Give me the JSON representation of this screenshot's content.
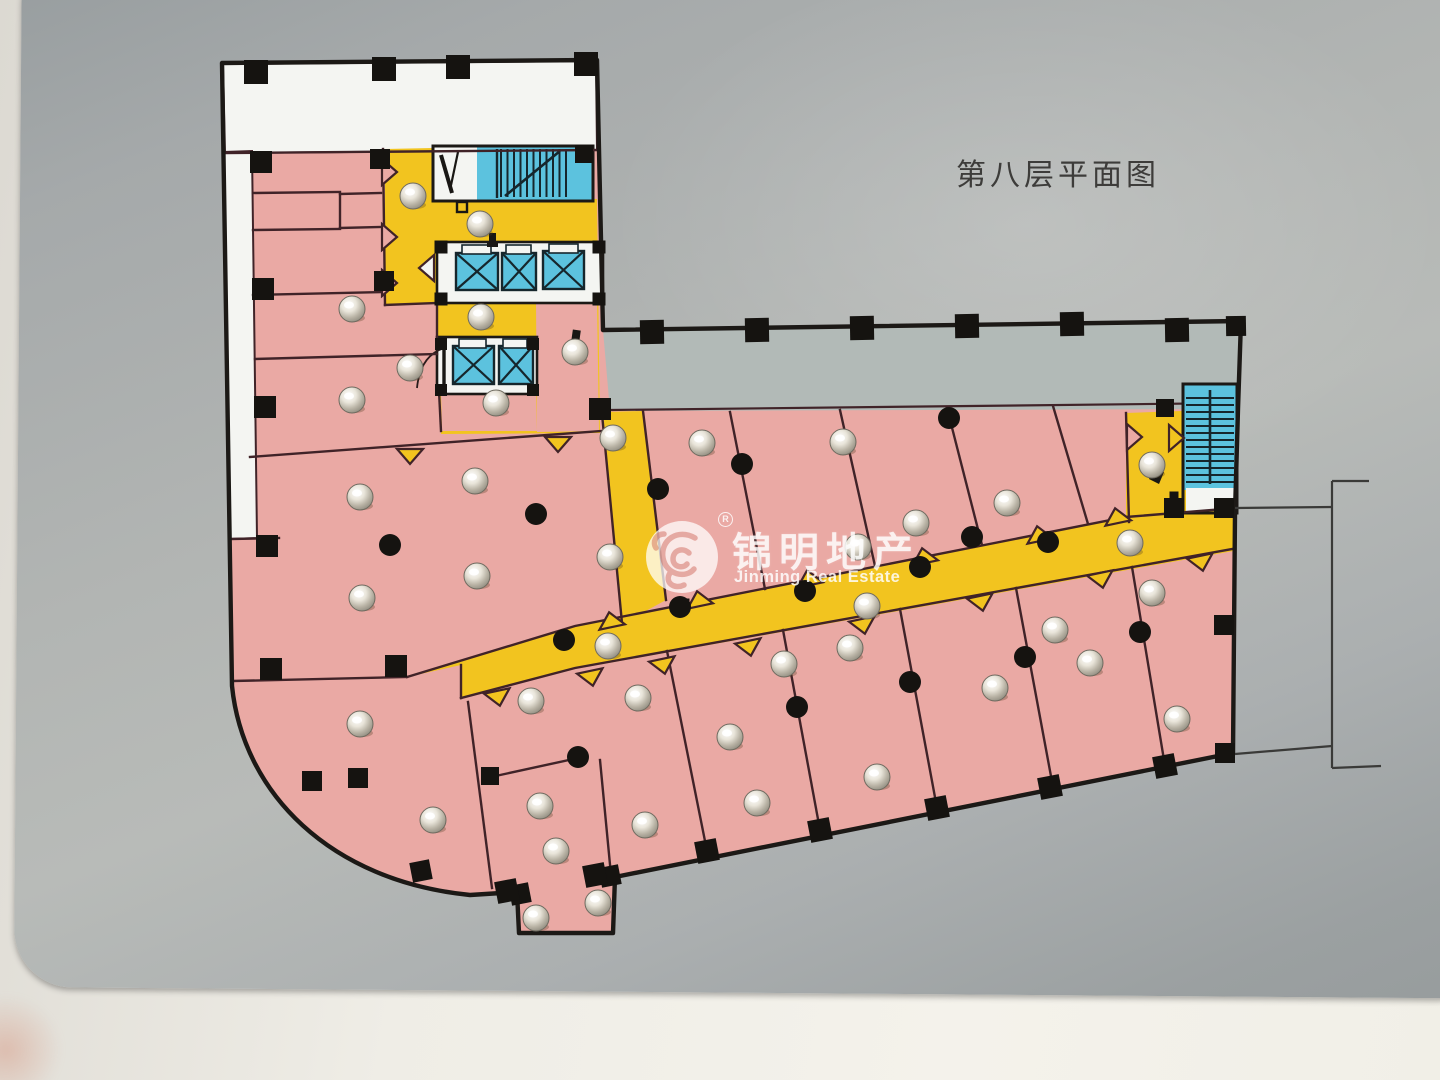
{
  "sign": {
    "title": "第八层平面图",
    "watermark": {
      "cn": "锦明地产",
      "en": "Jinming Real Estate",
      "registered": "R"
    }
  },
  "colors": {
    "room_pink": "#eaa9a4",
    "corridor_yellow": "#f2c41f",
    "stair_blue": "#5cc2de",
    "terrace_gray": "#b2bab7",
    "white_area": "#f4f5f2",
    "wall_dark": "#1c1916",
    "wall_thin": "#402328",
    "column_black": "#151310",
    "stair_detail": "#16262c",
    "panel_gray": "#aaaeaf",
    "frame_white": "#f2f0e9",
    "title_text": "#3d3c3a",
    "watermark_white": "#ffffff"
  },
  "floor_plan": {
    "round_columns": [
      [
        390,
        545
      ],
      [
        536,
        514
      ],
      [
        564,
        640
      ],
      [
        578,
        757
      ],
      [
        658,
        489
      ],
      [
        680,
        607
      ],
      [
        742,
        464
      ],
      [
        805,
        591
      ],
      [
        920,
        567
      ],
      [
        949,
        418
      ],
      [
        972,
        537
      ],
      [
        1048,
        542
      ],
      [
        797,
        707
      ],
      [
        910,
        682
      ],
      [
        1025,
        657
      ],
      [
        1140,
        632
      ]
    ],
    "square_columns": [
      [
        256,
        72,
        24,
        0
      ],
      [
        384,
        69,
        24,
        0
      ],
      [
        458,
        67,
        24,
        0
      ],
      [
        586,
        64,
        24,
        0
      ],
      [
        261,
        162,
        22,
        0
      ],
      [
        263,
        289,
        22,
        0
      ],
      [
        265,
        407,
        22,
        0
      ],
      [
        267,
        546,
        22,
        0
      ],
      [
        380,
        159,
        20,
        0
      ],
      [
        384,
        281,
        20,
        0
      ],
      [
        271,
        669,
        22,
        0
      ],
      [
        396,
        666,
        22,
        0
      ],
      [
        312,
        781,
        20,
        0
      ],
      [
        358,
        778,
        20,
        0
      ],
      [
        421,
        871,
        20,
        -11
      ],
      [
        490,
        776,
        18,
        0
      ],
      [
        520,
        894,
        20,
        -11
      ],
      [
        610,
        876,
        20,
        -11
      ],
      [
        600,
        409,
        22,
        0
      ],
      [
        584,
        154,
        18,
        0
      ],
      [
        652,
        332,
        24,
        -1
      ],
      [
        757,
        330,
        24,
        -1
      ],
      [
        862,
        328,
        24,
        -1
      ],
      [
        967,
        326,
        24,
        -1
      ],
      [
        1072,
        324,
        24,
        -1
      ],
      [
        1177,
        330,
        24,
        -1
      ],
      [
        1236,
        326,
        20,
        -1
      ],
      [
        507,
        891,
        22,
        -11
      ],
      [
        595,
        875,
        22,
        -11
      ],
      [
        707,
        851,
        22,
        -11
      ],
      [
        820,
        830,
        22,
        -11
      ],
      [
        937,
        808,
        22,
        -11
      ],
      [
        1050,
        787,
        22,
        -11
      ],
      [
        1165,
        766,
        22,
        -11
      ],
      [
        1224,
        508,
        20,
        0
      ],
      [
        1224,
        625,
        20,
        0
      ],
      [
        1225,
        753,
        20,
        0
      ],
      [
        1174,
        508,
        20,
        0
      ],
      [
        1165,
        408,
        18,
        0
      ],
      [
        441,
        247,
        13,
        0
      ],
      [
        599,
        247,
        13,
        0
      ],
      [
        441,
        299,
        13,
        0
      ],
      [
        599,
        299,
        13,
        0
      ],
      [
        441,
        344,
        12,
        0
      ],
      [
        533,
        344,
        12,
        0
      ],
      [
        441,
        390,
        12,
        0
      ],
      [
        533,
        390,
        12,
        0
      ],
      [
        684,
        604,
        11,
        0
      ],
      [
        1174,
        496,
        9,
        0
      ]
    ],
    "door_notches": [
      [
        383,
        172,
        90,
        "p"
      ],
      [
        383,
        237,
        90,
        "p"
      ],
      [
        383,
        283,
        90,
        "p"
      ],
      [
        433,
        268,
        270,
        "w"
      ],
      [
        410,
        450,
        180,
        "y"
      ],
      [
        558,
        438,
        180,
        "y"
      ],
      [
        612,
        626,
        348,
        "y"
      ],
      [
        700,
        605,
        348,
        "y"
      ],
      [
        810,
        584,
        348,
        "y"
      ],
      [
        925,
        562,
        348,
        "y"
      ],
      [
        1040,
        540,
        348,
        "y"
      ],
      [
        1118,
        522,
        348,
        "y"
      ],
      [
        1128,
        437,
        90,
        "p"
      ],
      [
        1170,
        438,
        90,
        "y"
      ],
      [
        497,
        692,
        168,
        "y"
      ],
      [
        590,
        672,
        168,
        "y"
      ],
      [
        662,
        660,
        168,
        "y"
      ],
      [
        748,
        642,
        168,
        "y"
      ],
      [
        862,
        620,
        168,
        "y"
      ],
      [
        980,
        597,
        168,
        "y"
      ],
      [
        1100,
        574,
        168,
        "y"
      ],
      [
        1200,
        557,
        168,
        "y"
      ]
    ],
    "screws": [
      [
        413,
        196
      ],
      [
        480,
        224
      ],
      [
        352,
        309
      ],
      [
        481,
        317
      ],
      [
        410,
        368
      ],
      [
        575,
        352
      ],
      [
        352,
        400
      ],
      [
        496,
        403
      ],
      [
        613,
        438
      ],
      [
        702,
        443
      ],
      [
        843,
        442
      ],
      [
        475,
        481
      ],
      [
        360,
        497
      ],
      [
        477,
        576
      ],
      [
        362,
        598
      ],
      [
        610,
        557
      ],
      [
        916,
        523
      ],
      [
        1007,
        503
      ],
      [
        858,
        547
      ],
      [
        867,
        606
      ],
      [
        1152,
        465
      ],
      [
        1130,
        543
      ],
      [
        1152,
        593
      ],
      [
        531,
        701
      ],
      [
        608,
        646
      ],
      [
        730,
        737
      ],
      [
        784,
        664
      ],
      [
        850,
        648
      ],
      [
        757,
        803
      ],
      [
        877,
        777
      ],
      [
        645,
        825
      ],
      [
        556,
        851
      ],
      [
        598,
        903
      ],
      [
        536,
        918
      ],
      [
        360,
        724
      ],
      [
        433,
        820
      ],
      [
        540,
        806
      ],
      [
        995,
        688
      ],
      [
        1090,
        663
      ],
      [
        1177,
        719
      ],
      [
        1055,
        630
      ],
      [
        638,
        698
      ]
    ],
    "elevator_cars": [
      [
        456,
        253,
        42,
        37
      ],
      [
        502,
        253,
        34,
        37
      ],
      [
        543,
        251,
        41,
        38
      ],
      [
        453,
        346,
        41,
        38
      ],
      [
        499,
        346,
        34,
        38
      ]
    ],
    "elevator_doors": [
      [
        462,
        245,
        29,
        9
      ],
      [
        506,
        245,
        25,
        9
      ],
      [
        549,
        244,
        29,
        9
      ],
      [
        459,
        339,
        27,
        9
      ],
      [
        503,
        339,
        24,
        9
      ]
    ]
  }
}
